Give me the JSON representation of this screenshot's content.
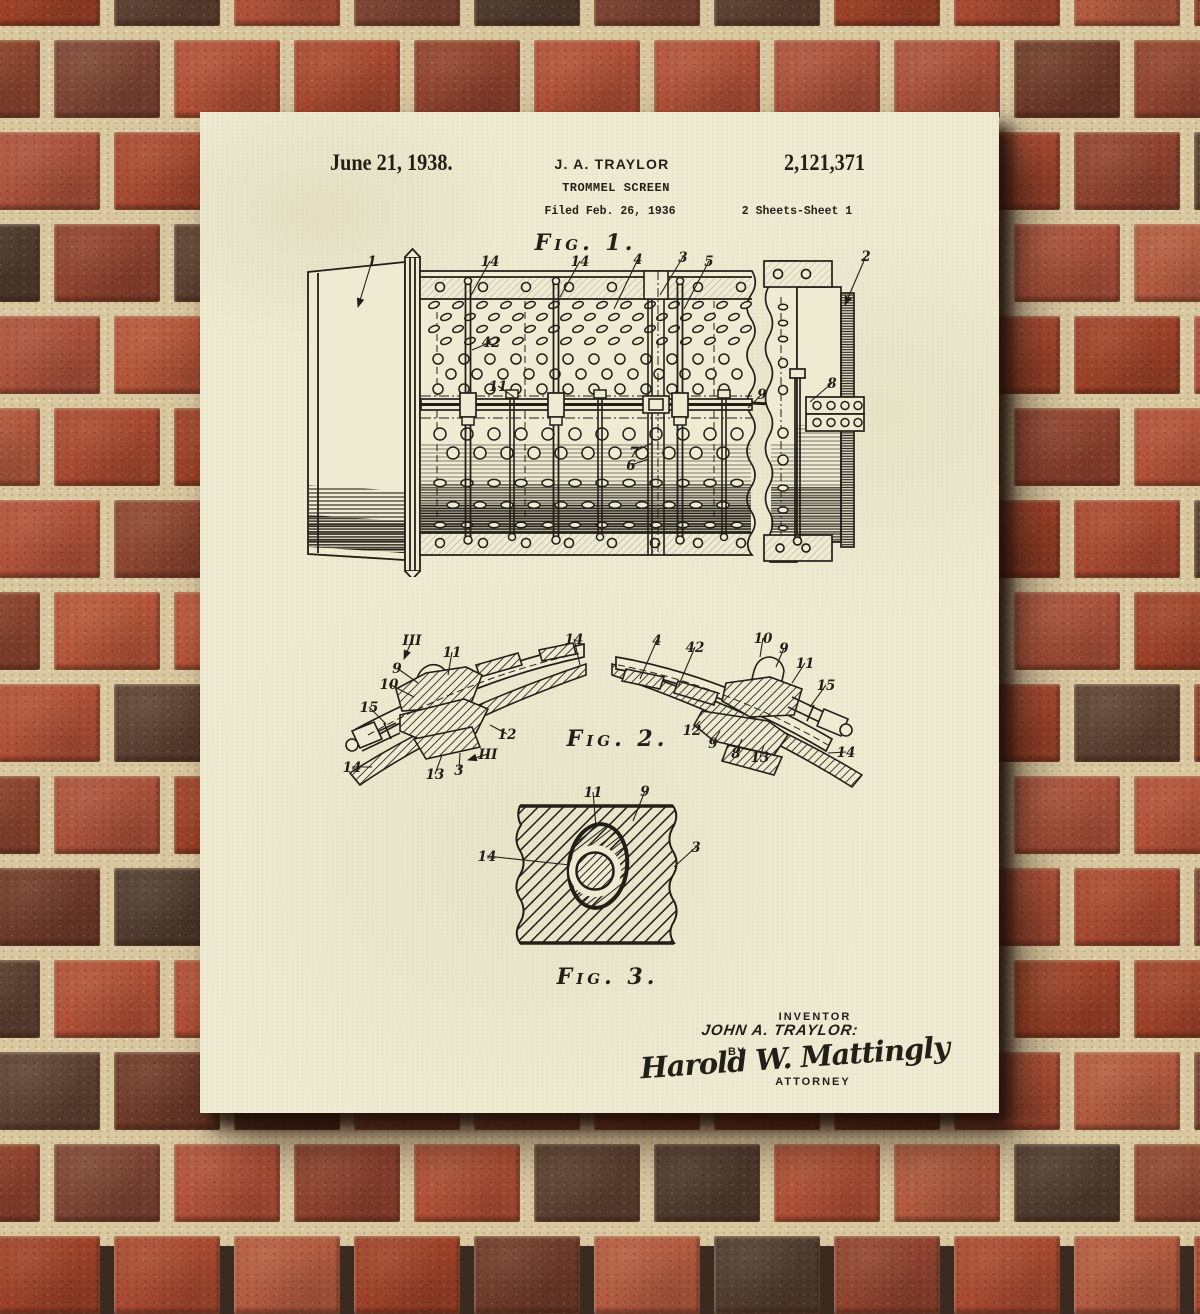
{
  "colors": {
    "paper": "#eeebd2",
    "ink": "#221f18",
    "mortar": "#d9c7a0",
    "shadow": "rgba(30,15,8,0.8)",
    "brick_palette": [
      "#a84a31",
      "#b05138",
      "#9d4229",
      "#b25b40",
      "#8f4330",
      "#a84a31",
      "#b5563a",
      "#6d3b2b",
      "#5c4233",
      "#9d4229",
      "#b05138",
      "#7c4535",
      "#4e3d30",
      "#aa523c",
      "#b0523a",
      "#8c4631"
    ]
  },
  "poster": {
    "header": {
      "date": "June 21, 1938.",
      "inventor": "J. A. TRAYLOR",
      "patent_number": "2,121,371",
      "title": "TROMMEL SCREEN",
      "filed": "Filed Feb. 26, 1936",
      "sheet_info": "2 Sheets-Sheet 1"
    },
    "figures": {
      "fig1": {
        "caption": "Fig. 1.",
        "labels": [
          {
            "t": "1",
            "x": 72,
            "y": 19,
            "lx": 58,
            "ly": 60,
            "a": true
          },
          {
            "t": "14",
            "x": 190,
            "y": 19,
            "lx": 170,
            "ly": 50
          },
          {
            "t": "14",
            "x": 280,
            "y": 19,
            "lx": 260,
            "ly": 50
          },
          {
            "t": "4",
            "x": 338,
            "y": 17,
            "lx": 314,
            "ly": 62
          },
          {
            "t": "3",
            "x": 383,
            "y": 15,
            "lx": 360,
            "ly": 48
          },
          {
            "t": "5",
            "x": 409,
            "y": 19,
            "lx": 384,
            "ly": 62
          },
          {
            "t": "2",
            "x": 566,
            "y": 14,
            "lx": 545,
            "ly": 58,
            "a": true
          },
          {
            "t": "42",
            "x": 191,
            "y": 100,
            "lx": 172,
            "ly": 103
          },
          {
            "t": "11",
            "x": 198,
            "y": 144,
            "lx": 214,
            "ly": 150
          },
          {
            "t": "9",
            "x": 462,
            "y": 152,
            "lx": 448,
            "ly": 161
          },
          {
            "t": "8",
            "x": 532,
            "y": 141,
            "lx": 510,
            "ly": 155
          },
          {
            "t": "7",
            "x": 334,
            "y": 210,
            "lx": 352,
            "ly": 196
          },
          {
            "t": "6",
            "x": 331,
            "y": 223,
            "lx": 349,
            "ly": 212
          }
        ]
      },
      "fig2": {
        "caption": "Fig. 2.",
        "labels": [
          {
            "t": "III",
            "x": 82,
            "y": 18,
            "lx": 74,
            "ly": 32,
            "a": true
          },
          {
            "t": "11",
            "x": 122,
            "y": 30,
            "lx": 118,
            "ly": 48
          },
          {
            "t": "9",
            "x": 67,
            "y": 46,
            "lx": 88,
            "ly": 56
          },
          {
            "t": "10",
            "x": 59,
            "y": 62,
            "lx": 84,
            "ly": 70
          },
          {
            "t": "15",
            "x": 39,
            "y": 85,
            "lx": 56,
            "ly": 97
          },
          {
            "t": "14",
            "x": 22,
            "y": 145,
            "lx": 42,
            "ly": 140
          },
          {
            "t": "13",
            "x": 105,
            "y": 152,
            "lx": 112,
            "ly": 128
          },
          {
            "t": "3",
            "x": 129,
            "y": 148,
            "lx": 130,
            "ly": 126
          },
          {
            "t": "III",
            "x": 158,
            "y": 132,
            "lx": 138,
            "ly": 133,
            "a": true
          },
          {
            "t": "12",
            "x": 177,
            "y": 112,
            "lx": 160,
            "ly": 98
          },
          {
            "t": "14",
            "x": 244,
            "y": 17,
            "lx": 250,
            "ly": 38
          },
          {
            "t": "4",
            "x": 327,
            "y": 18,
            "lx": 310,
            "ly": 52
          },
          {
            "t": "42",
            "x": 365,
            "y": 25,
            "lx": 348,
            "ly": 60
          },
          {
            "t": "10",
            "x": 433,
            "y": 16,
            "lx": 430,
            "ly": 30
          },
          {
            "t": "9",
            "x": 454,
            "y": 26,
            "lx": 446,
            "ly": 40
          },
          {
            "t": "11",
            "x": 475,
            "y": 41,
            "lx": 462,
            "ly": 56
          },
          {
            "t": "15",
            "x": 496,
            "y": 63,
            "lx": 480,
            "ly": 80
          },
          {
            "t": "12",
            "x": 362,
            "y": 108,
            "lx": 370,
            "ly": 94
          },
          {
            "t": "9",
            "x": 383,
            "y": 121,
            "lx": 390,
            "ly": 104
          },
          {
            "t": "8",
            "x": 406,
            "y": 131,
            "lx": 412,
            "ly": 112
          },
          {
            "t": "13",
            "x": 430,
            "y": 135,
            "lx": 434,
            "ly": 118
          },
          {
            "t": "14",
            "x": 516,
            "y": 130,
            "lx": 498,
            "ly": 126
          }
        ]
      },
      "fig3": {
        "caption": "Fig. 3.",
        "labels": [
          {
            "t": "11",
            "x": 123,
            "y": 12,
            "lx": 126,
            "ly": 42
          },
          {
            "t": "9",
            "x": 175,
            "y": 11,
            "lx": 163,
            "ly": 36
          },
          {
            "t": "14",
            "x": 17,
            "y": 76,
            "lx": 100,
            "ly": 80
          },
          {
            "t": "3",
            "x": 226,
            "y": 67,
            "lx": 204,
            "ly": 82
          }
        ]
      }
    },
    "signature": {
      "inventor_heading": "INVENTOR",
      "inventor_signature": "JOHN A. TRAYLOR:",
      "by_label": "BY",
      "attorney_signature": "Harold W. Mattingly",
      "attorney_heading": "ATTORNEY"
    }
  }
}
